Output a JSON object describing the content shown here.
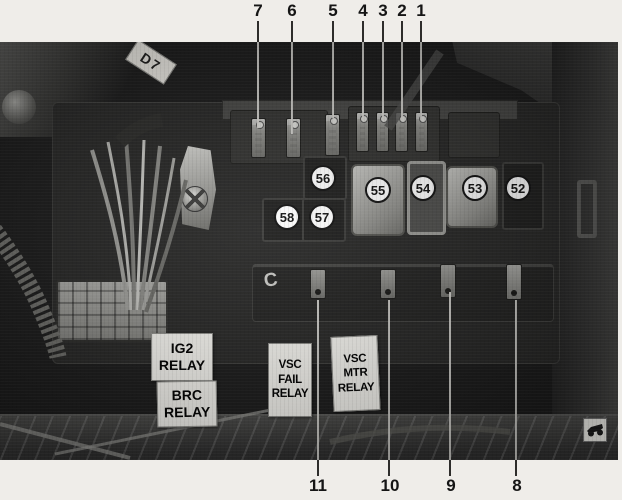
{
  "figure": {
    "description": "Engine compartment fuse and relay box photograph with numbered callouts",
    "tag": "D7",
    "molded_mark": "C"
  },
  "callouts": {
    "top": [
      {
        "label": "7"
      },
      {
        "label": "6"
      },
      {
        "label": "5"
      },
      {
        "label": "4"
      },
      {
        "label": "3"
      },
      {
        "label": "2"
      },
      {
        "label": "1"
      }
    ],
    "bottom": [
      {
        "label": "11"
      },
      {
        "label": "10"
      },
      {
        "label": "9"
      },
      {
        "label": "8"
      }
    ],
    "circled": [
      {
        "label": "56"
      },
      {
        "label": "57"
      },
      {
        "label": "58"
      },
      {
        "label": "55"
      },
      {
        "label": "54"
      },
      {
        "label": "53"
      },
      {
        "label": "52"
      }
    ]
  },
  "labels": {
    "ig2": [
      "IG2",
      "RELAY"
    ],
    "brc": [
      "BRC",
      "RELAY"
    ],
    "vsc_fail": [
      "VSC",
      "FAIL",
      "RELAY"
    ],
    "vsc_mtr": [
      "VSC",
      "MTR",
      "RELAY"
    ]
  },
  "colors": {
    "paper": "#efede9",
    "photo_dark": "#1c1c1c",
    "callout_text": "#151515",
    "circle_bg": "#ffffff",
    "plate_bg": "#f7f6f1",
    "leader_on_photo": "#d8d7d3"
  }
}
